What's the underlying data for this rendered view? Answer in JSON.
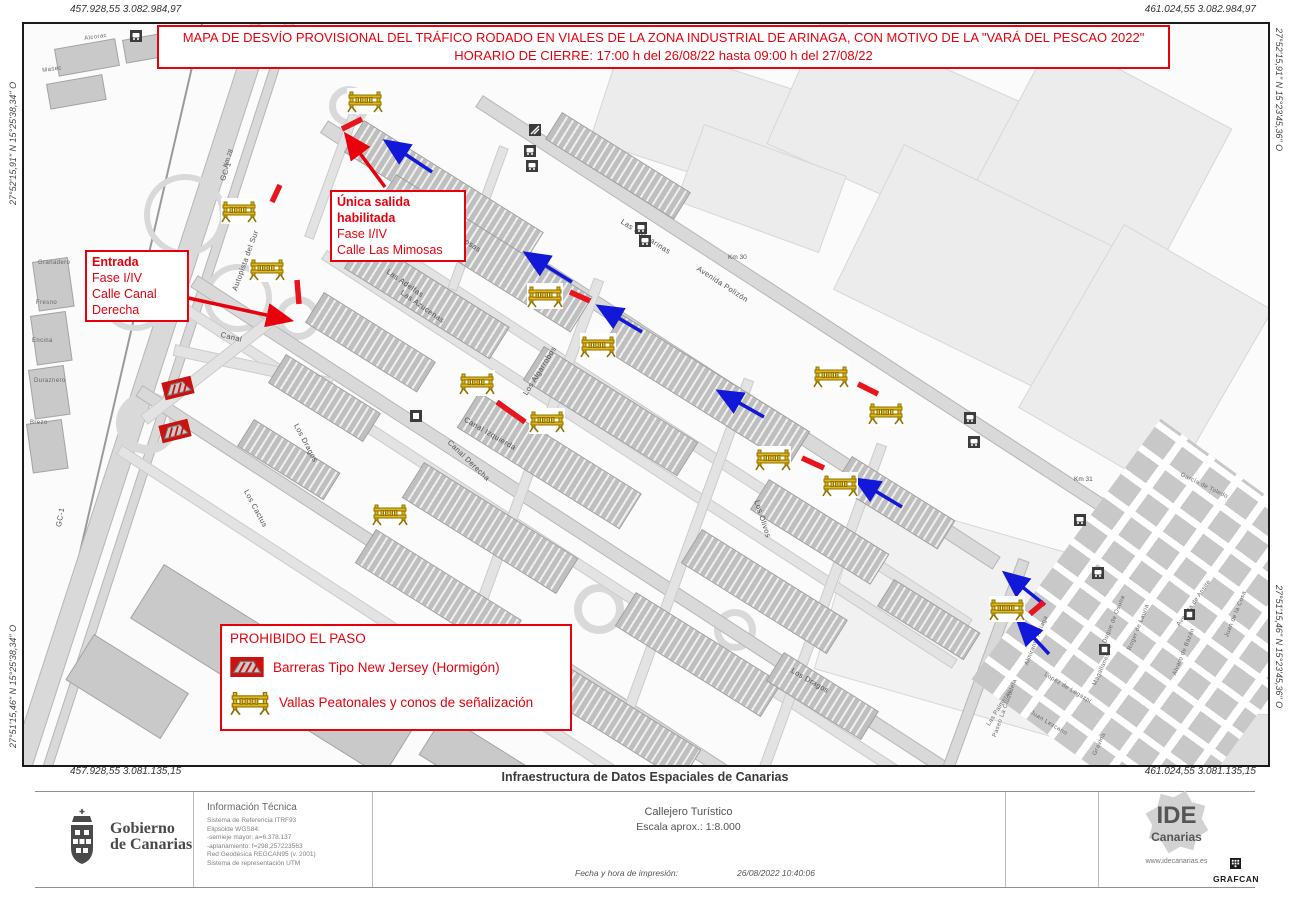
{
  "banner": {
    "line1": "MAPA DE DESVÍO PROVISIONAL DEL TRÁFICO RODADO EN VIALES DE LA ZONA INDUSTRIAL DE ARINAGA, CON MOTIVO DE LA \"VARÁ DEL PESCAO 2022\"",
    "line2": "HORARIO DE CIERRE: 17:00 h del 26/08/22 hasta 09:00 h del 27/08/22"
  },
  "geo": {
    "top_left": "457.928,55  3.082.984,97",
    "top_right": "461.024,55  3.082.984,97",
    "bottom_left": "457.928,55  3.081.135,15",
    "bottom_right": "461.024,55  3.081.135,15",
    "left_top": "27°52'15,91\" N  15°25'38,34\" O",
    "left_bottom": "27°51'15,46\" N  15°25'38,34\" O",
    "right_top": "27°52'15,91\" N  15°23'45,36\" O",
    "right_bottom": "27°51'15,46\" N  15°23'45,36\" O"
  },
  "callouts": {
    "exit": {
      "line1": "Única salida",
      "line2": "habilitada",
      "line3": "Fase I/IV",
      "line4": "Calle Las Mimosas"
    },
    "entry": {
      "line1": "Entrada",
      "line2": "Fase I/IV",
      "line3": "Calle Canal",
      "line4": "Derecha"
    }
  },
  "legend": {
    "title": "PROHIBIDO EL PASO",
    "items": [
      {
        "icon": "new-jersey-barrier-icon",
        "label": "Barreras Tipo New Jersey (Hormigón)"
      },
      {
        "icon": "pedestrian-barrier-icon",
        "label": "Vallas Peatonales y conos de señalización"
      }
    ]
  },
  "map": {
    "streets": [
      {
        "name": "Las Mimosas"
      },
      {
        "name": "Las Casuarinas"
      },
      {
        "name": "Avenida Polizón"
      },
      {
        "name": "Las Adelfas"
      },
      {
        "name": "Las Azucenas"
      },
      {
        "name": "Los Algarrobos"
      },
      {
        "name": "Canal Izquierda"
      },
      {
        "name": "Canal Derecha"
      },
      {
        "name": "Los Dragos"
      },
      {
        "name": "Los Cactus"
      },
      {
        "name": "Los Olivos"
      },
      {
        "name": "Los Dragos"
      },
      {
        "name": "Las Palmeras"
      },
      {
        "name": "Almirante Arriaga"
      },
      {
        "name": "Duque de Osuna"
      },
      {
        "name": "Roger de Lauria"
      },
      {
        "name": "Alvaro de Bazán"
      },
      {
        "name": "Avenida de Ansite"
      },
      {
        "name": "Magallanes"
      },
      {
        "name": "López de Legazpi"
      },
      {
        "name": "Juan Lezcano"
      },
      {
        "name": "Gravina"
      },
      {
        "name": "Paseo La Ciudadela"
      },
      {
        "name": "Juan de la Cosa"
      },
      {
        "name": "García de Toledo"
      },
      {
        "name": "GC-1"
      },
      {
        "name": "Autopista del Sur"
      },
      {
        "name": "GC-1"
      },
      {
        "name": "Canal"
      },
      {
        "name": "Alcorac"
      },
      {
        "name": "Masec"
      },
      {
        "name": "Granadero"
      },
      {
        "name": "Fresno"
      },
      {
        "name": "Encina"
      },
      {
        "name": "Duraznero"
      },
      {
        "name": "Brezo"
      }
    ],
    "km_markers": [
      {
        "label": "Km 28"
      },
      {
        "label": "Km 30"
      },
      {
        "label": "Km 31"
      }
    ]
  },
  "footer": {
    "center_title": "Infraestructura de Datos Espaciales de Canarias",
    "org": {
      "line1": "Gobierno",
      "line2": "de Canarias"
    },
    "info": {
      "title": "Información Técnica",
      "lines": [
        "Sistema de Referencia ITRF93",
        "Elipsoide WGS84:",
        "-semieje mayor: a=6.378.137",
        "-aplanamiento: f=298,257223563",
        "Red Geodésica REGCAN95 (v. 2001)",
        "Sistema de representación UTM"
      ]
    },
    "product": "Callejero Turístico",
    "scale": "Escala aprox.: 1:8.000",
    "print_label": "Fecha y hora de impresión:",
    "print_value": "26/08/2022 10:40:06",
    "ide": {
      "line1": "IDE",
      "line2": "Canarias",
      "website": "www.idecanarias.es"
    },
    "grafcan": "GRAFCAN"
  },
  "colors": {
    "annotation_red": "#e8000d",
    "arrow_blue": "#1118d8",
    "closure_red": "#e8141e",
    "barrier_yellow": "#e2b71c"
  }
}
